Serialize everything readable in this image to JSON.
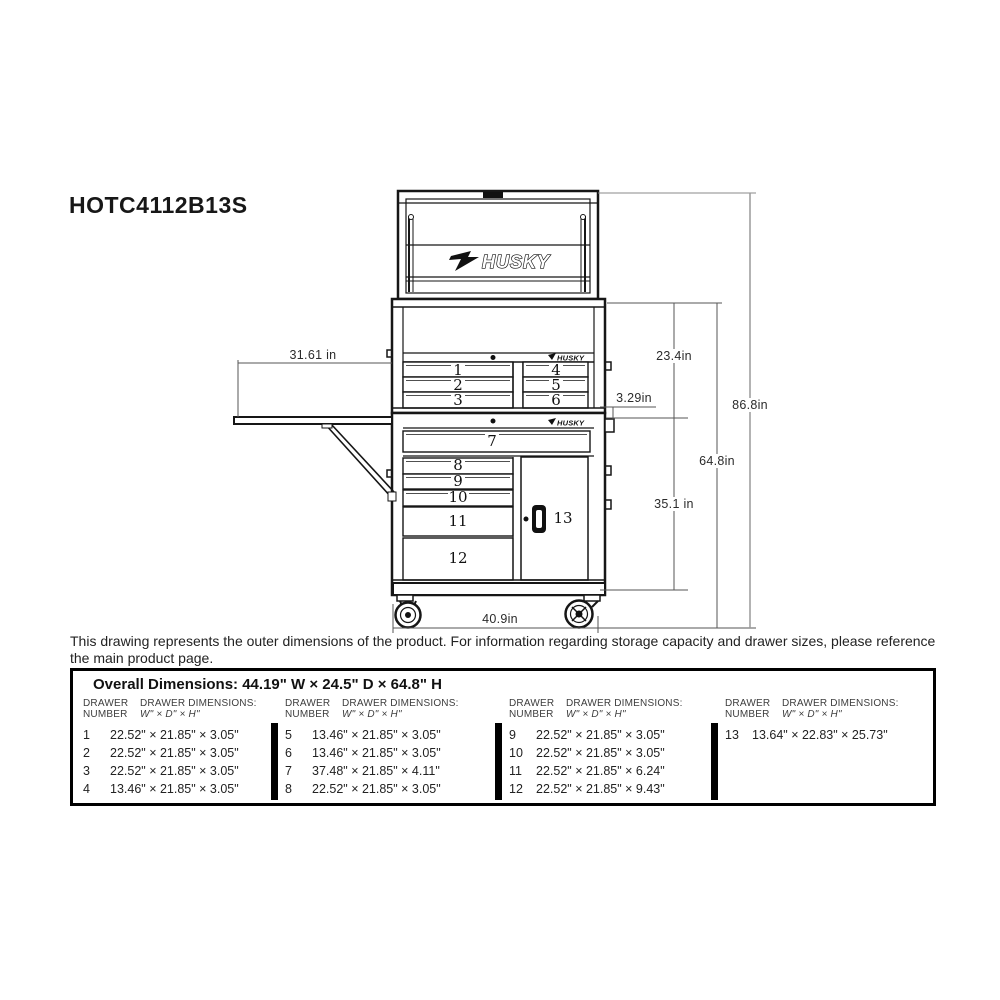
{
  "title": "HOTC4112B13S",
  "brand": {
    "logo_text": "HUSKY"
  },
  "drawing": {
    "drawer_numbers": [
      "1",
      "2",
      "3",
      "4",
      "5",
      "6",
      "7",
      "8",
      "9",
      "10",
      "11",
      "12",
      "13"
    ],
    "dims": {
      "side_table": "31.61 in",
      "chest_height": "23.4in",
      "handle": "3.29in",
      "overall_height": "86.8in",
      "cabinet_height": "64.8in",
      "lower_section": "35.1 in",
      "width": "40.9in"
    }
  },
  "note": {
    "line1": "This drawing represents the outer dimensions of the product. For information regarding storage capacity and drawer sizes, please reference",
    "line2": "the main product page."
  },
  "table": {
    "overall": "Overall Dimensions: 44.19\" W  ×  24.5\" D  ×  64.8\" H",
    "header": {
      "num1": "DRAWER",
      "num2": "NUMBER",
      "dim1": "DRAWER DIMENSIONS:",
      "dim2": "W\" × D\" × H\""
    },
    "groups": [
      {
        "rows": [
          {
            "n": "1",
            "d": "22.52\" × 21.85\" × 3.05\""
          },
          {
            "n": "2",
            "d": "22.52\" × 21.85\" × 3.05\""
          },
          {
            "n": "3",
            "d": "22.52\" × 21.85\" × 3.05\""
          },
          {
            "n": "4",
            "d": "13.46\" × 21.85\" × 3.05\""
          }
        ]
      },
      {
        "rows": [
          {
            "n": "5",
            "d": "13.46\" × 21.85\" × 3.05\""
          },
          {
            "n": "6",
            "d": "13.46\" × 21.85\" × 3.05\""
          },
          {
            "n": "7",
            "d": "37.48\" × 21.85\" × 4.11\""
          },
          {
            "n": "8",
            "d": "22.52\" × 21.85\" × 3.05\""
          }
        ]
      },
      {
        "rows": [
          {
            "n": "9",
            "d": "22.52\" × 21.85\" × 3.05\""
          },
          {
            "n": "10",
            "d": "22.52\" × 21.85\" × 3.05\""
          },
          {
            "n": "11",
            "d": "22.52\" × 21.85\" × 6.24\""
          },
          {
            "n": "12",
            "d": "22.52\" × 21.85\" × 9.43\""
          }
        ]
      },
      {
        "rows": [
          {
            "n": "13",
            "d": "13.64\" × 22.83\" × 25.73\""
          }
        ]
      }
    ]
  }
}
